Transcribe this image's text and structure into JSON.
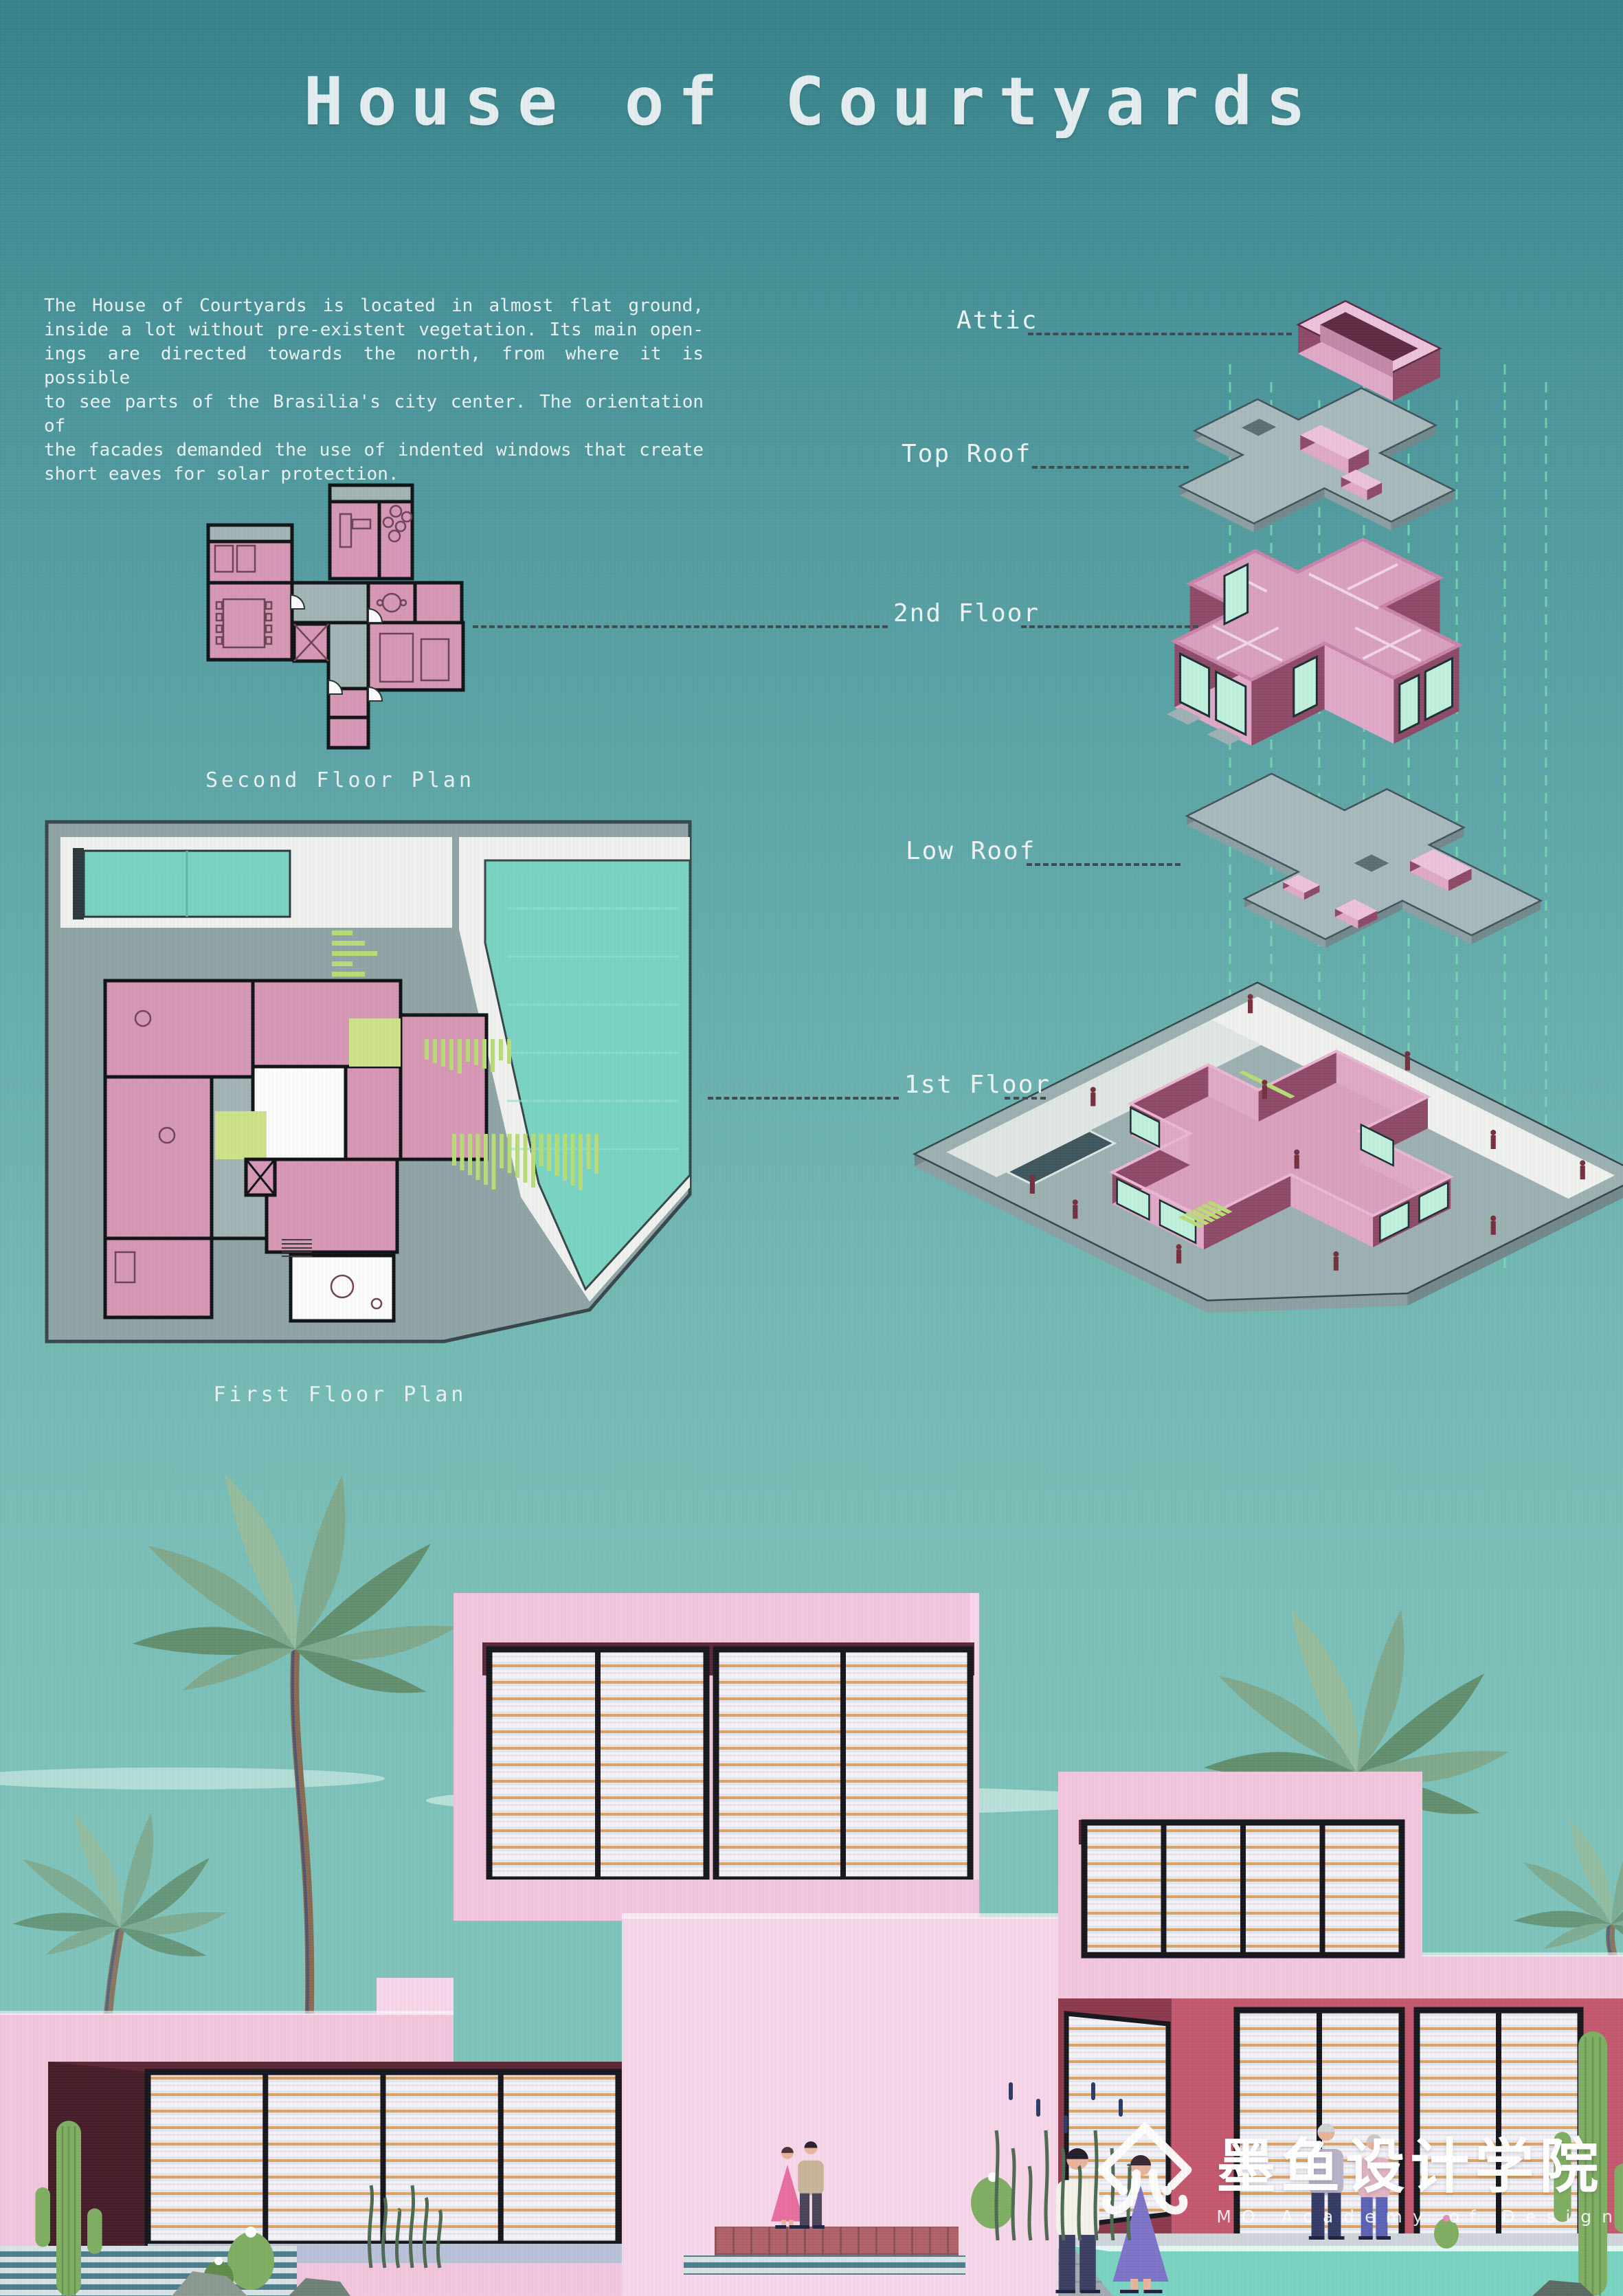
{
  "title": "House of Courtyards",
  "description": {
    "lines": [
      "The House of Courtyards is located in almost flat ground,",
      "inside a lot without pre-existent vegetation. Its main open-",
      "ings are directed towards the north, from where it is possible",
      "to see parts of the Brasilia's city center. The orientation of",
      "the facades demanded the use of indented windows that create",
      "short eaves for solar protection."
    ]
  },
  "axon": {
    "labels": {
      "attic": "Attic",
      "top_roof": "Top Roof",
      "second_floor": "2nd Floor",
      "low_roof": "Low Roof",
      "first_floor": "1st Floor"
    }
  },
  "plans": {
    "second_caption": "Second Floor Plan",
    "first_caption": "First Floor Plan"
  },
  "logo": {
    "zh": "墨鱼设计学院",
    "en": "MO Academy of Design"
  },
  "colors": {
    "ink": "#e7eff0",
    "leader": "#3e4c50",
    "mint": "#79e2b4",
    "slab_top": "#a6b9bb",
    "slab_left": "#8ba0a3",
    "slab_right": "#73898c",
    "slab_edge": "#43545a",
    "slab_hole": "#5b6f73",
    "pink_top": "#ecc2da",
    "pink_left": "#dfa8c6",
    "pink_right": "#8e4a68",
    "pink_floor": "#d9a0be",
    "pink_deep": "#5f2c44",
    "pink_mid": "#c487a8",
    "glass": "#bff0dc",
    "glass_frame": "#1c2f35",
    "step_grey": "#9fb0b2",
    "plan_pink": "#d697b5",
    "plan_grey": "#a2b4b6",
    "plan_dark": "#101417",
    "plan_white": "#fafbfa",
    "plan_green": "#cde189",
    "plan_bar": "#b8dc74",
    "water": "#79d3c2",
    "water_deep": "#2c3a3e",
    "site_grey": "#8fa4a6",
    "site_edge": "#37474b",
    "court_white": "#eff1ee",
    "pool_dark": "#3f575f",
    "sky_cloud": "#e8f7f3",
    "house_pink": "#f1c6dd",
    "house_pink_light": "#f6d6e8",
    "soffit": "#5c2839",
    "maroon": "#5d2736",
    "maroon_deep": "#461e29",
    "crimson": "#c4596e",
    "crimson_dark": "#8e3a4d",
    "louver_bg": "#e6e5ef",
    "louver_hi": "#f4f4f8",
    "louver_orange": "#dda45f",
    "frame": "#17171e",
    "terrace": "#b7c1d8",
    "step_teal": "#4e7d8c",
    "step_pale": "#d7e2e6",
    "plank": "#9fadb0",
    "plank_line": "#8a989b",
    "deck": "#b06268",
    "deck_line": "#8f4f57",
    "lawn": "#8ed172",
    "cactus": "#7fae62",
    "cactus_dark": "#5f8c4a",
    "palm": "#7fa98c",
    "palm_dark": "#62906f",
    "palm_light": "#95bc9d",
    "trunk": "#8a6a52",
    "trunk_line": "#44507a",
    "skin": "#e8b39a",
    "people_dark": "#76303f",
    "white": "#ffffff"
  }
}
